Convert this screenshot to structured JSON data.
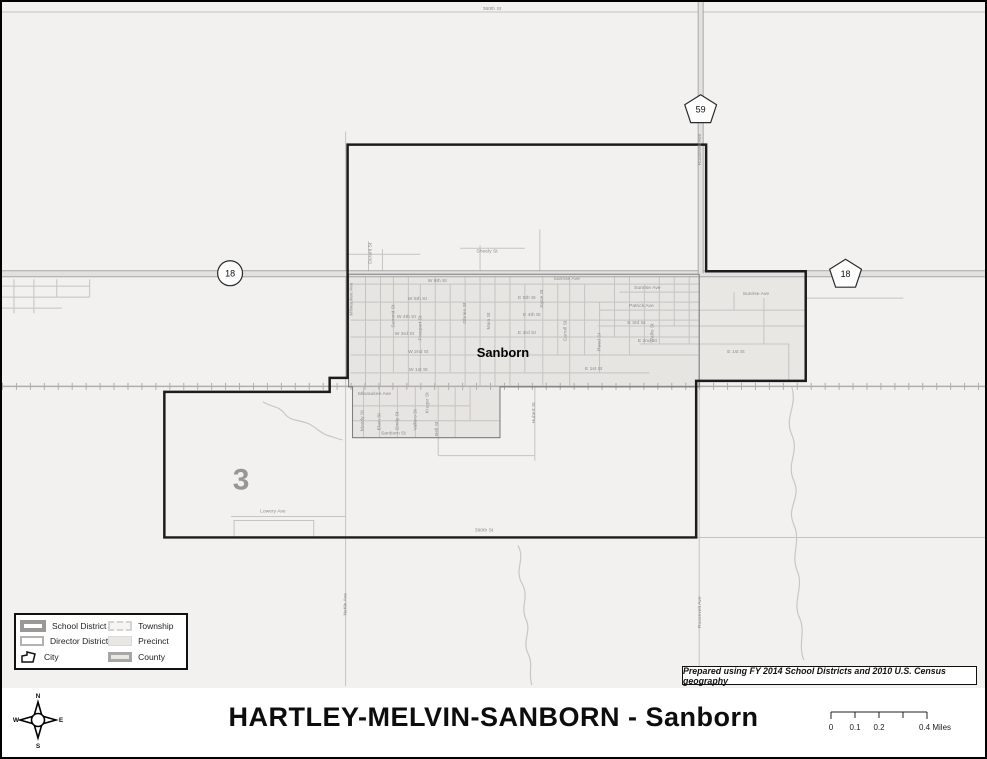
{
  "title": "HARTLEY-MELVIN-SANBORN - Sanborn",
  "attribution": "Prepared using FY 2014 School Districts and 2010 U.S. Census geography",
  "map": {
    "city_label": "Sanborn",
    "district_number": "3",
    "highway_shields": [
      {
        "shape": "pentagon",
        "label": "59"
      },
      {
        "shape": "circle",
        "label": "18"
      },
      {
        "shape": "pentagon",
        "label": "18"
      }
    ],
    "street_labels": [
      {
        "text": "360th St",
        "x": 492,
        "y": 8,
        "rot": 0
      },
      {
        "text": "390th St",
        "x": 484,
        "y": 531,
        "rot": 0
      },
      {
        "text": "Lowery Ave",
        "x": 272,
        "y": 512,
        "rot": 0
      },
      {
        "text": "Milwaukee Ave",
        "x": 374,
        "y": 394,
        "rot": 0
      },
      {
        "text": "Sanborn St",
        "x": 393,
        "y": 434,
        "rot": 0
      },
      {
        "text": "Sheely St",
        "x": 487,
        "y": 251,
        "rot": 0
      },
      {
        "text": "W 6th St",
        "x": 437,
        "y": 281,
        "rot": 0
      },
      {
        "text": "W 5th St",
        "x": 417,
        "y": 299,
        "rot": 0
      },
      {
        "text": "W 4th St",
        "x": 406,
        "y": 317,
        "rot": 0
      },
      {
        "text": "W 3rd St",
        "x": 404,
        "y": 334,
        "rot": 0
      },
      {
        "text": "W 2nd St",
        "x": 418,
        "y": 352,
        "rot": 0
      },
      {
        "text": "W 1st St",
        "x": 418,
        "y": 370,
        "rot": 0
      },
      {
        "text": "E 5th St",
        "x": 527,
        "y": 298,
        "rot": 0
      },
      {
        "text": "E 4th St",
        "x": 532,
        "y": 315,
        "rot": 0
      },
      {
        "text": "E 3rd St",
        "x": 527,
        "y": 333,
        "rot": 0
      },
      {
        "text": "E 3rd St",
        "x": 637,
        "y": 323,
        "rot": 0
      },
      {
        "text": "E 2nd St",
        "x": 648,
        "y": 341,
        "rot": 0
      },
      {
        "text": "E 1st St",
        "x": 594,
        "y": 369,
        "rot": 0
      },
      {
        "text": "E 1st St",
        "x": 737,
        "y": 352,
        "rot": 0
      },
      {
        "text": "Sunrise Ave",
        "x": 567,
        "y": 279,
        "rot": 0
      },
      {
        "text": "Sunrise Ave",
        "x": 648,
        "y": 288,
        "rot": 0
      },
      {
        "text": "Sunrise Ave",
        "x": 757,
        "y": 294,
        "rot": 0
      },
      {
        "text": "Patrick Ave",
        "x": 642,
        "y": 306,
        "rot": 0
      },
      {
        "text": "Nettle Ave",
        "x": 346,
        "y": 604,
        "rot": -90
      },
      {
        "text": "Roosevelt Ave",
        "x": 702,
        "y": 612,
        "rot": -90
      },
      {
        "text": "Roosevelt Ave",
        "x": 702,
        "y": 148,
        "rot": -90
      },
      {
        "text": "Milwaukee Ave",
        "x": 352,
        "y": 298,
        "rot": -90
      },
      {
        "text": "Summit St",
        "x": 394,
        "y": 315,
        "rot": -90
      },
      {
        "text": "Freeport St",
        "x": 421,
        "y": 327,
        "rot": -90
      },
      {
        "text": "Obrien St",
        "x": 466,
        "y": 312,
        "rot": -90
      },
      {
        "text": "Main St",
        "x": 490,
        "y": 320,
        "rot": -90
      },
      {
        "text": "Joyce St",
        "x": 543,
        "y": 298,
        "rot": -90
      },
      {
        "text": "Carroll St",
        "x": 567,
        "y": 330,
        "rot": -90
      },
      {
        "text": "Reed St",
        "x": 601,
        "y": 341,
        "rot": -90
      },
      {
        "text": "Wallis St",
        "x": 654,
        "y": 332,
        "rot": -90
      },
      {
        "text": "Durant St",
        "x": 371,
        "y": 252,
        "rot": -90
      },
      {
        "text": "Moody St",
        "x": 363,
        "y": 420,
        "rot": -90
      },
      {
        "text": "Elain St",
        "x": 380,
        "y": 421,
        "rot": -90
      },
      {
        "text": "Emily St",
        "x": 398,
        "y": 420,
        "rot": -90
      },
      {
        "text": "Vallero St",
        "x": 416,
        "y": 419,
        "rot": -90
      },
      {
        "text": "Kruger St",
        "x": 428,
        "y": 402,
        "rot": -90
      },
      {
        "text": "Bell St",
        "x": 438,
        "y": 428,
        "rot": -90
      },
      {
        "text": "Hubert St",
        "x": 535,
        "y": 412,
        "rot": -90
      }
    ]
  },
  "legend": {
    "items": [
      {
        "label": "School District",
        "symbol": "school-district"
      },
      {
        "label": "Director District",
        "symbol": "director-district"
      },
      {
        "label": "City",
        "symbol": "city"
      },
      {
        "label": "Township",
        "symbol": "township"
      },
      {
        "label": "Precinct",
        "symbol": "precinct"
      },
      {
        "label": "County",
        "symbol": "county"
      }
    ]
  },
  "compass": {
    "n": "N",
    "e": "E",
    "s": "S",
    "w": "W"
  },
  "scale_bar": {
    "labels": [
      "0",
      "0.1",
      "0.2",
      "0.4 Miles"
    ],
    "ticks": [
      0,
      0.1,
      0.2,
      0.3,
      0.4
    ]
  },
  "colors": {
    "map_background": "#f2f1ef",
    "city_fill": "#e7e5e2",
    "extension_fill": "#e9e7e4",
    "road": "#c6c4c2",
    "highway_casing": "#a8a6a4",
    "highway_fill": "#e3e1df",
    "railroad": "#b0aeac",
    "district_boundary": "#1c1c1c",
    "label_gray": "#8e8c8a"
  }
}
